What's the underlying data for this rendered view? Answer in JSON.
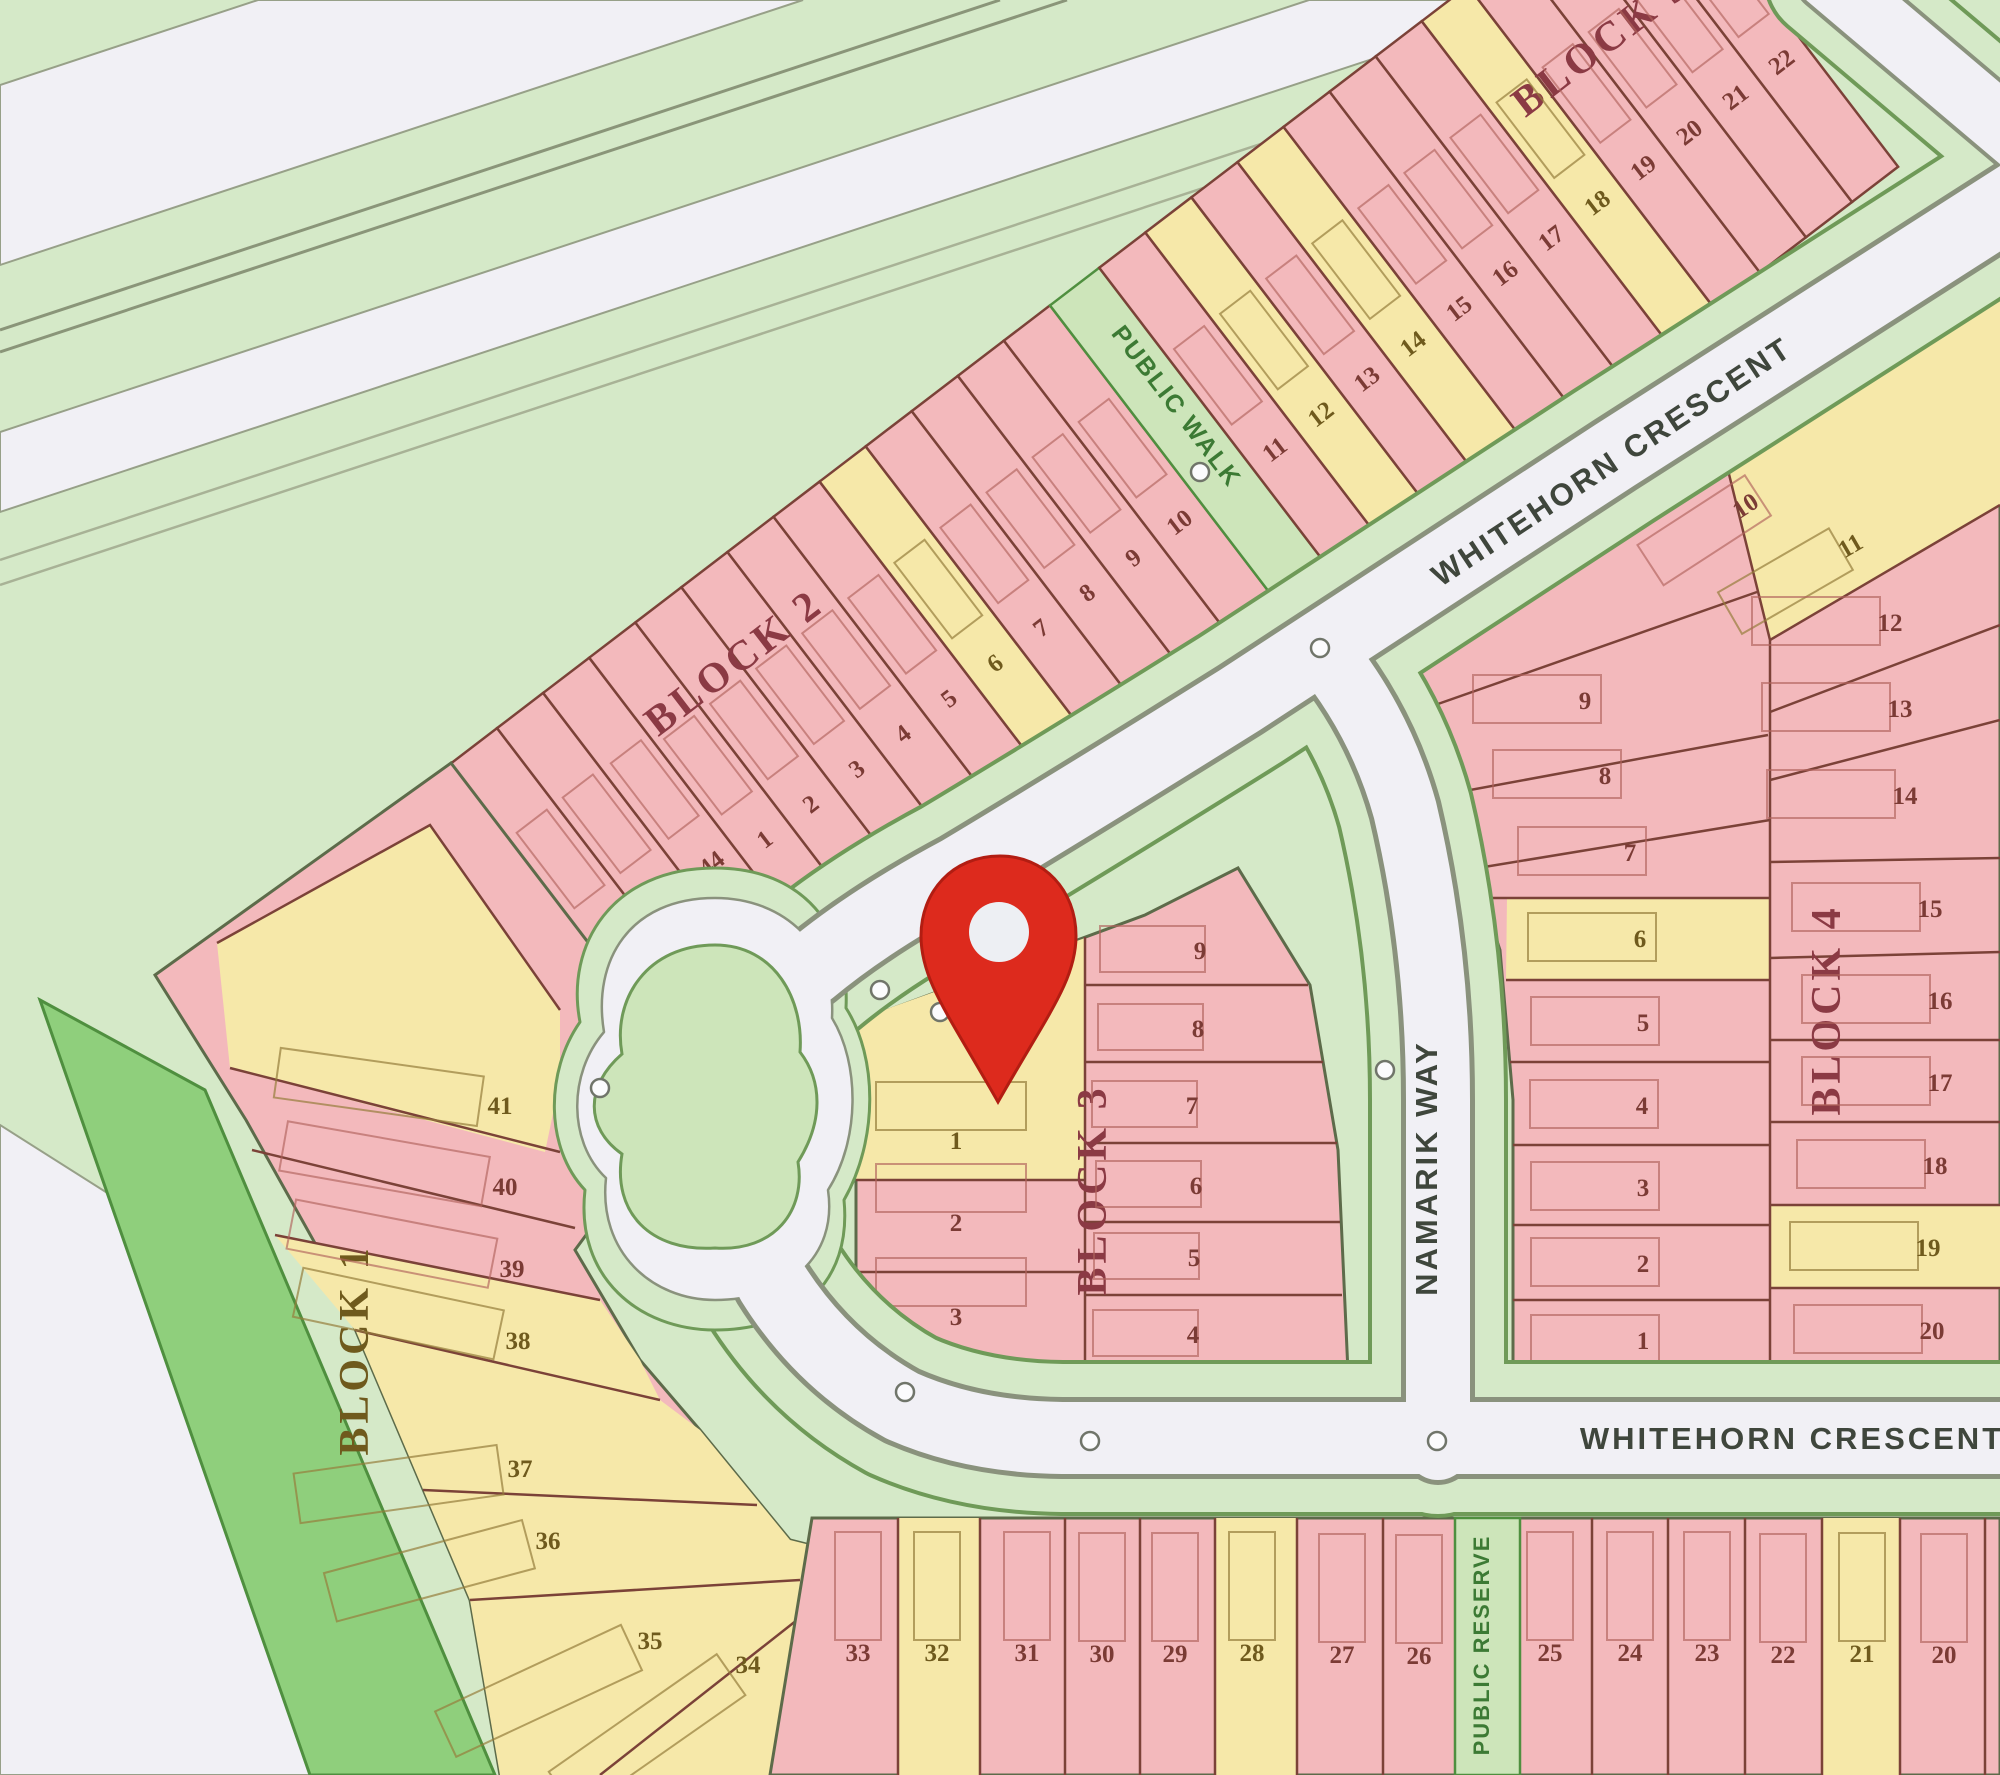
{
  "map": {
    "streets": {
      "whitehorn_diagonal": "WHITEHORN CRESCENT",
      "whitehorn_horizontal": "WHITEHORN CRESCENT",
      "namarik": "NAMARIK WAY"
    },
    "features": {
      "public_walk": "PUBLIC WALK",
      "public_reserve": "PUBLIC RESERVE"
    },
    "blocks": {
      "block1": "BLOCK 1",
      "block2": "BLOCK 2",
      "block3": "BLOCK 3",
      "block4": "BLOCK 4",
      "block5": "BLOCK 5"
    },
    "colors": {
      "bg": "#d5e9c8",
      "pink": "#f3b9bc",
      "yellow": "#f6e8a9",
      "road": "#f1f0f5",
      "verge": "#cde5ba",
      "strip_green": "#8fcf7c",
      "lotline": "#7b4238",
      "blockline": "#5d6b4a",
      "roadline": "#8a927d",
      "vergeline": "#6f9a58",
      "maroon": "#8b3a44",
      "olive": "#6f5a1d",
      "streettext": "#3f463c",
      "pubtext": "#3c7a34",
      "pin": "#dd2a1d"
    },
    "pin": {
      "x": 1000,
      "y": 928
    },
    "lot_groups": [
      {
        "id": "g-band-lots",
        "foot": {
          "dx": -19,
          "dy": -140,
          "w": 38,
          "h": 95
        },
        "lots": [
          {
            "n": "42",
            "x": -175,
            "y": -30,
            "c": "p"
          },
          {
            "n": "43",
            "x": -117,
            "y": -30,
            "c": "p"
          },
          {
            "n": "44",
            "x": -58,
            "y": -28,
            "c": "p"
          },
          {
            "n": "1",
            "x": -1,
            "y": -15,
            "c": "p"
          },
          {
            "n": "2",
            "x": 57,
            "y": -15,
            "c": "p"
          },
          {
            "n": "3",
            "x": 115,
            "y": -15,
            "c": "p"
          },
          {
            "n": "4",
            "x": 173,
            "y": -15,
            "c": "p"
          },
          {
            "n": "5",
            "x": 231,
            "y": -15,
            "c": "p"
          },
          {
            "n": "6",
            "x": 289,
            "y": -15,
            "c": "y"
          },
          {
            "n": "7",
            "x": 347,
            "y": -15,
            "c": "p"
          },
          {
            "n": "8",
            "x": 405,
            "y": -15,
            "c": "p"
          },
          {
            "n": "9",
            "x": 463,
            "y": -15,
            "c": "p"
          },
          {
            "n": "10",
            "x": 521,
            "y": -15,
            "c": "p"
          },
          {
            "n": "11",
            "x": 641,
            "y": -15,
            "c": "p"
          },
          {
            "n": "12",
            "x": 699,
            "y": -15,
            "c": "y"
          },
          {
            "n": "13",
            "x": 757,
            "y": -15,
            "c": "p"
          },
          {
            "n": "14",
            "x": 815,
            "y": -15,
            "c": "y"
          },
          {
            "n": "15",
            "x": 873,
            "y": -15,
            "c": "p"
          },
          {
            "n": "16",
            "x": 931,
            "y": -15,
            "c": "p"
          },
          {
            "n": "17",
            "x": 989,
            "y": -15,
            "c": "p"
          },
          {
            "n": "18",
            "x": 1047,
            "y": -15,
            "c": "y"
          },
          {
            "n": "19",
            "x": 1105,
            "y": -15,
            "c": "p"
          },
          {
            "n": "20",
            "x": 1163,
            "y": -15,
            "c": "p"
          },
          {
            "n": "21",
            "x": 1221,
            "y": -15,
            "c": "p"
          },
          {
            "n": "22",
            "x": 1279,
            "y": -15,
            "c": "p"
          }
        ]
      },
      {
        "id": "g-central-left-lots",
        "foot": {
          "dx": -80,
          "dy": -58,
          "w": 150,
          "h": 48
        },
        "lots": [
          {
            "n": "1",
            "x": 956,
            "y": 1140,
            "c": "y"
          },
          {
            "n": "2",
            "x": 956,
            "y": 1222,
            "c": "p"
          },
          {
            "n": "3",
            "x": 956,
            "y": 1316,
            "c": "p"
          }
        ]
      },
      {
        "id": "g-central-right-lots",
        "foot": {
          "dx": -100,
          "dy": -24,
          "w": 105,
          "h": 46
        },
        "lots": [
          {
            "n": "9",
            "x": 1200,
            "y": 950,
            "c": "p"
          },
          {
            "n": "8",
            "x": 1198,
            "y": 1028,
            "c": "p"
          },
          {
            "n": "7",
            "x": 1192,
            "y": 1105,
            "c": "p"
          },
          {
            "n": "6",
            "x": 1196,
            "y": 1185,
            "c": "p"
          },
          {
            "n": "5",
            "x": 1194,
            "y": 1257,
            "c": "p"
          },
          {
            "n": "4",
            "x": 1193,
            "y": 1334,
            "c": "p"
          }
        ]
      },
      {
        "id": "g-block4-left-lots",
        "foot": {
          "dx": -112,
          "dy": -25,
          "w": 128,
          "h": 48
        },
        "lots": [
          {
            "n": "10",
            "x": 1745,
            "y": 505,
            "c": "p",
            "r": -33
          },
          {
            "n": "9",
            "x": 1585,
            "y": 700,
            "c": "p"
          },
          {
            "n": "8",
            "x": 1605,
            "y": 775,
            "c": "p"
          },
          {
            "n": "7",
            "x": 1630,
            "y": 852,
            "c": "p"
          },
          {
            "n": "6",
            "x": 1640,
            "y": 938,
            "c": "y"
          },
          {
            "n": "5",
            "x": 1643,
            "y": 1022,
            "c": "p"
          },
          {
            "n": "4",
            "x": 1642,
            "y": 1105,
            "c": "p"
          },
          {
            "n": "3",
            "x": 1643,
            "y": 1187,
            "c": "p"
          },
          {
            "n": "2",
            "x": 1643,
            "y": 1263,
            "c": "p"
          },
          {
            "n": "1",
            "x": 1643,
            "y": 1340,
            "c": "p"
          }
        ]
      },
      {
        "id": "g-block4-right-lots",
        "foot": {
          "dx": -138,
          "dy": -25,
          "w": 128,
          "h": 48
        },
        "lots": [
          {
            "n": "11",
            "x": 1850,
            "y": 545,
            "c": "y",
            "r": -30
          },
          {
            "n": "12",
            "x": 1890,
            "y": 622,
            "c": "p"
          },
          {
            "n": "13",
            "x": 1900,
            "y": 708,
            "c": "p"
          },
          {
            "n": "14",
            "x": 1905,
            "y": 795,
            "c": "p"
          },
          {
            "n": "15",
            "x": 1930,
            "y": 908,
            "c": "p"
          },
          {
            "n": "16",
            "x": 1940,
            "y": 1000,
            "c": "p"
          },
          {
            "n": "17",
            "x": 1940,
            "y": 1082,
            "c": "p"
          },
          {
            "n": "18",
            "x": 1935,
            "y": 1165,
            "c": "p"
          },
          {
            "n": "19",
            "x": 1928,
            "y": 1247,
            "c": "y"
          },
          {
            "n": "20",
            "x": 1932,
            "y": 1330,
            "c": "p"
          }
        ]
      },
      {
        "id": "g-bottom-lots",
        "foot": {
          "dx": -23,
          "dy": -120,
          "w": 46,
          "h": 108
        },
        "lots": [
          {
            "n": "33",
            "x": 858,
            "y": 1652,
            "c": "p"
          },
          {
            "n": "32",
            "x": 937,
            "y": 1652,
            "c": "y"
          },
          {
            "n": "31",
            "x": 1027,
            "y": 1652,
            "c": "p"
          },
          {
            "n": "30",
            "x": 1102,
            "y": 1653,
            "c": "p"
          },
          {
            "n": "29",
            "x": 1175,
            "y": 1653,
            "c": "p"
          },
          {
            "n": "28",
            "x": 1252,
            "y": 1652,
            "c": "y"
          },
          {
            "n": "27",
            "x": 1342,
            "y": 1654,
            "c": "p"
          },
          {
            "n": "26",
            "x": 1419,
            "y": 1655,
            "c": "p"
          },
          {
            "n": "25",
            "x": 1550,
            "y": 1652,
            "c": "p"
          },
          {
            "n": "24",
            "x": 1630,
            "y": 1652,
            "c": "p"
          },
          {
            "n": "23",
            "x": 1707,
            "y": 1652,
            "c": "p"
          },
          {
            "n": "22",
            "x": 1783,
            "y": 1654,
            "c": "p"
          },
          {
            "n": "21",
            "x": 1862,
            "y": 1653,
            "c": "y"
          },
          {
            "n": "20",
            "x": 1944,
            "y": 1654,
            "c": "p"
          }
        ]
      },
      {
        "id": "g-block1-lots",
        "foot": {
          "dx": -225,
          "dy": -26,
          "w": 205,
          "h": 50
        },
        "lots": [
          {
            "n": "41",
            "x": 500,
            "y": 1105,
            "c": "y",
            "fr": 8
          },
          {
            "n": "40",
            "x": 505,
            "y": 1186,
            "c": "p",
            "fr": 10
          },
          {
            "n": "39",
            "x": 512,
            "y": 1268,
            "c": "p",
            "fr": 11
          },
          {
            "n": "38",
            "x": 518,
            "y": 1340,
            "c": "y",
            "fr": 12
          },
          {
            "n": "37",
            "x": 520,
            "y": 1468,
            "c": "y",
            "fr": -8
          },
          {
            "n": "36",
            "x": 548,
            "y": 1540,
            "c": "y",
            "fr": -15
          },
          {
            "n": "35",
            "x": 650,
            "y": 1640,
            "c": "y",
            "fr": -25
          },
          {
            "n": "34",
            "x": 748,
            "y": 1664,
            "c": "y",
            "fr": -35
          }
        ]
      }
    ]
  }
}
